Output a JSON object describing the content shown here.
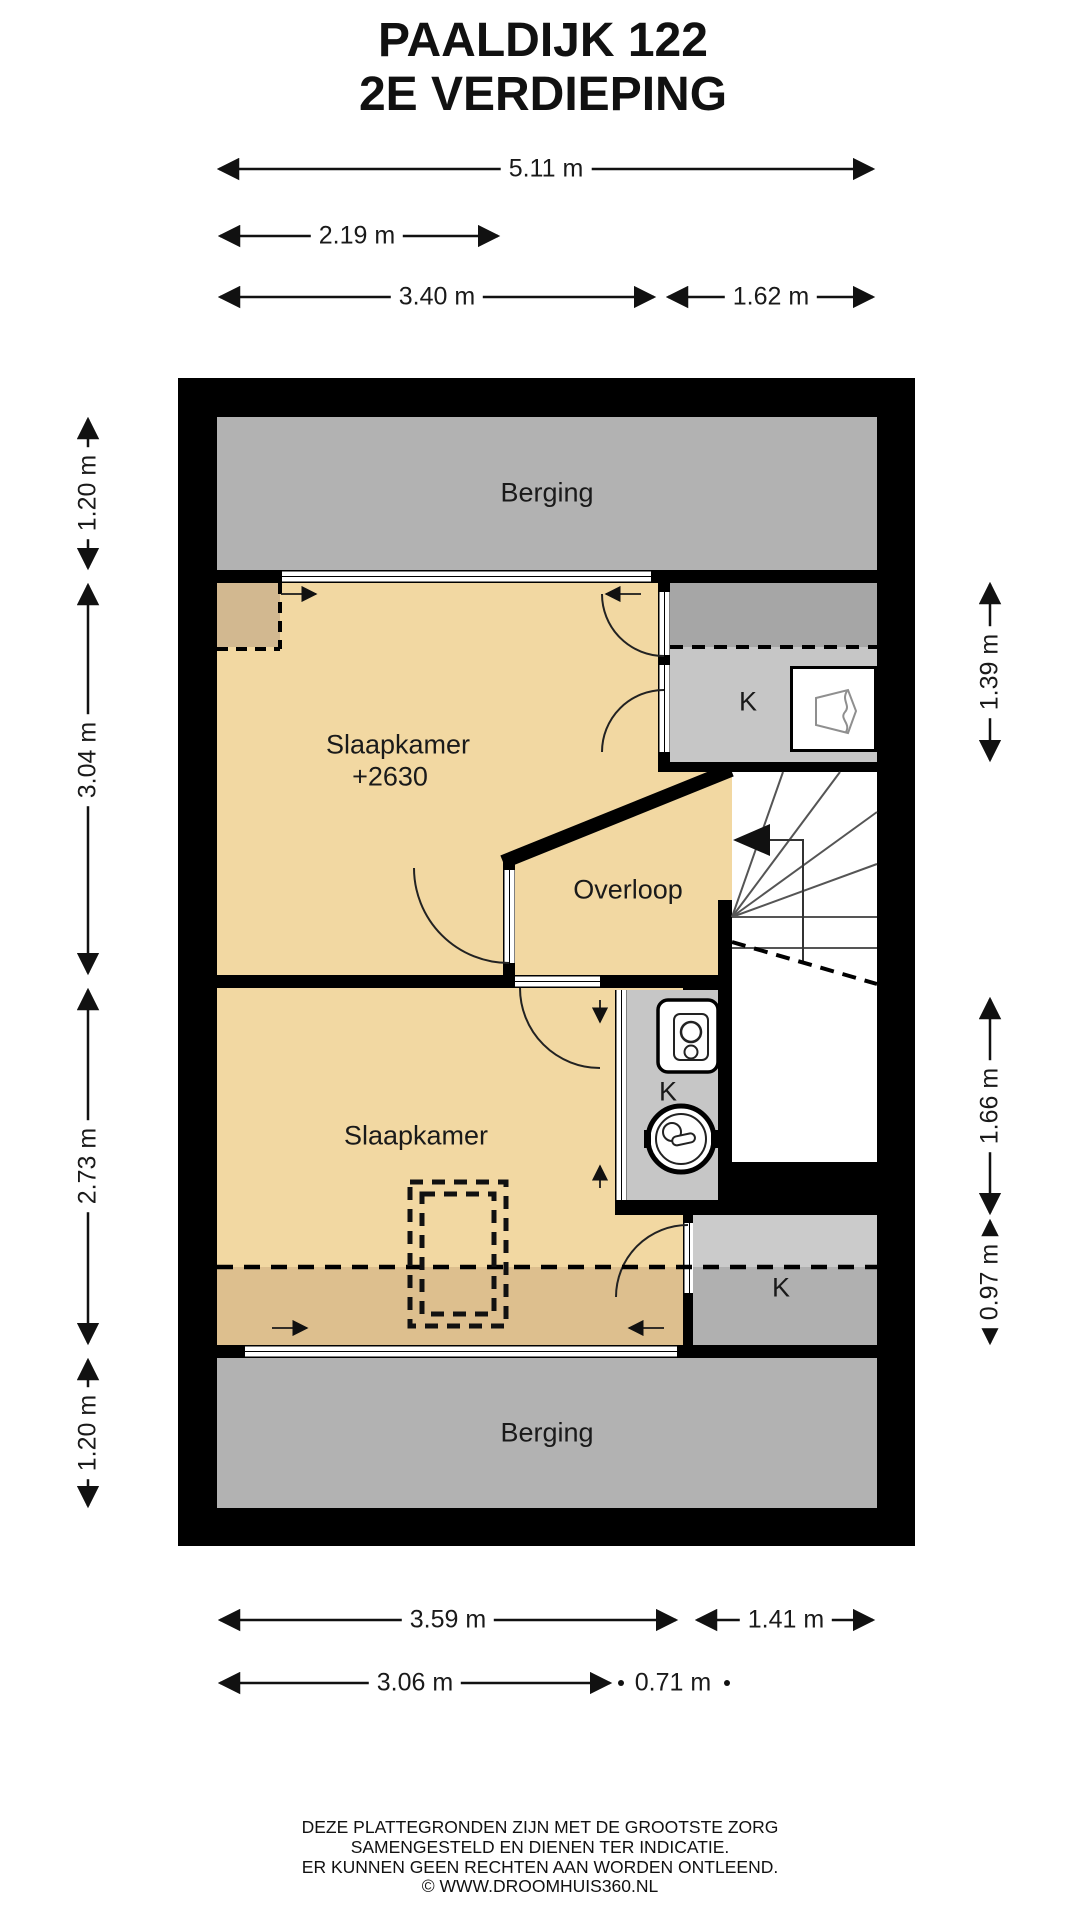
{
  "title": {
    "line1": "PAALDIJK 122",
    "line2": "2E VERDIEPING"
  },
  "rooms": {
    "berging_top": "Berging",
    "slaapkamer_1": "Slaapkamer",
    "slaapkamer_1_level": "+2630",
    "overloop": "Overloop",
    "slaapkamer_2": "Slaapkamer",
    "berging_bottom": "Berging",
    "closet_top_right": "K",
    "closet_middle": "K",
    "closet_bottom_right": "K"
  },
  "dimensions": {
    "top": [
      {
        "label": "5.11 m"
      },
      {
        "label": "2.19 m"
      },
      {
        "label": "3.40 m"
      },
      {
        "label": "1.62 m"
      }
    ],
    "left": [
      {
        "label": "1.20 m"
      },
      {
        "label": "3.04 m"
      },
      {
        "label": "2.73 m"
      },
      {
        "label": "1.20 m"
      }
    ],
    "right": [
      {
        "label": "1.39 m"
      },
      {
        "label": "1.66 m"
      },
      {
        "label": "0.97 m"
      }
    ],
    "bottom": [
      {
        "label": "3.59 m"
      },
      {
        "label": "1.41 m"
      },
      {
        "label": "3.06 m"
      },
      {
        "label": "0.71 m"
      }
    ]
  },
  "footer": {
    "line1": "DEZE PLATTEGRONDEN ZIJN MET DE GROOTSTE ZORG",
    "line2": "SAMENGESTELD EN DIENEN TER INDICATIE.",
    "line3": "ER KUNNEN GEEN RECHTEN AAN WORDEN ONTLEEND.",
    "line4": "© WWW.DROOMHUIS360.NL"
  },
  "colors": {
    "wall": "#000000",
    "storage_gray": "#b2b2b2",
    "room_tan": "#f2d8a2",
    "room_tan_low_ceiling": "#ddbf8e",
    "nook_tan": "#d2b890",
    "closet_gray": "#c6c6c6",
    "closet_gray_dark": "#a6a6a6",
    "closet_bottom_light": "#cbcbcb",
    "closet_bottom_dark": "#b0b0b0"
  }
}
